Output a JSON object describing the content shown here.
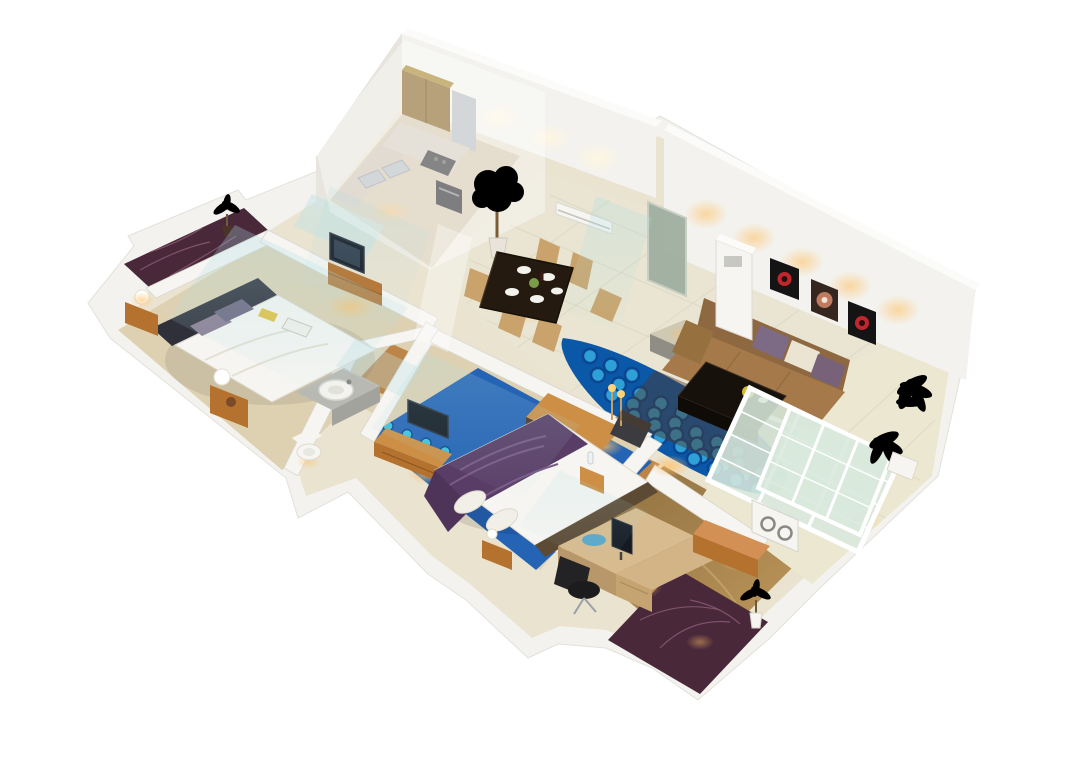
{
  "scene": {
    "type": "isometric-3d-apartment-floorplan-render",
    "background": "#ffffff",
    "rooms": [
      {
        "id": "master-bedroom",
        "furniture": [
          "double-bed",
          "headboard",
          "purple-pillows",
          "two-nightstands-with-lamps",
          "tv-dresser",
          "wall-tv"
        ]
      },
      {
        "id": "master-balcony",
        "furniture": [
          "dark-marble-floor",
          "potted-plant"
        ]
      },
      {
        "id": "bathroom",
        "furniture": [
          "round-basin-vanity",
          "toilet",
          "glass-partition"
        ]
      },
      {
        "id": "kitchen",
        "furniture": [
          "l-counter",
          "double-sink",
          "cooktop",
          "oven",
          "overhead-brown-cabinet",
          "fridge"
        ]
      },
      {
        "id": "dining-area",
        "furniture": [
          "dark-dining-table",
          "six-tan-chairs",
          "white-plates",
          "potted-tree"
        ]
      },
      {
        "id": "entry-hall",
        "furniture": [
          "recessed-entry-door",
          "console-sideboard",
          "floor-candles",
          "blue-river-floor-feature"
        ]
      },
      {
        "id": "living-room",
        "furniture": [
          "brown-sofa",
          "throw-cushions",
          "dark-coffee-table",
          "gray-ottoman",
          "tower-ac-unit",
          "wall-ac-unit",
          "three-wall-artworks",
          "french-glass-doors"
        ]
      },
      {
        "id": "second-bedroom",
        "furniture": [
          "double-bed",
          "purple-blanket",
          "blue-dotted-carpet",
          "tv-dresser",
          "nightstand"
        ]
      },
      {
        "id": "home-office",
        "furniture": [
          "l-shaped-desk",
          "monitor",
          "black-office-chair",
          "orange-cabinet",
          "glass-window-wall"
        ]
      },
      {
        "id": "right-balcony",
        "furniture": [
          "cream-tile-floor",
          "palm-plants",
          "white-planter",
          "outdoor-ac-unit"
        ]
      },
      {
        "id": "office-balcony",
        "furniture": [
          "dark-marble-floor",
          "potted-plant"
        ]
      }
    ]
  },
  "palette": {
    "wall": "#f3f2ee",
    "wallSide": "#e7e5de",
    "wallTop": "#fbfbf9",
    "underlay": "#e7dec8",
    "floorCream": "#e9e5d2",
    "tileLine": "#d5cfb6",
    "floorBeige": "#ded1b2",
    "floorKitchen": "#d5c9ae",
    "woodFloor": "#bd8448",
    "woodPlank": "#a06a34",
    "officeFloorA": "#8a6c3e",
    "officeFloorB": "#c39c5e",
    "balconyTile": "#ece7d0",
    "marble": "#49283a",
    "marbleVein": "#96647a",
    "river": "#0b57a8",
    "riverDot": "#2f9fd8",
    "riverRing": "#0a4790",
    "carpet": "#2563b4",
    "carpetDot": "#3ec2dc",
    "woodFurniture": "#b5722f",
    "woodFurnitureLight": "#cd8f45",
    "darkTable": "#241a10",
    "sofa": "#a5794a",
    "sofaBack": "#8d6840",
    "cushionPurple": "#7d6a84",
    "cushionCream": "#ece4d2",
    "blanketPurple": "#5a3d66",
    "chairTan": "#c9a36b",
    "white": "#f6f5f1",
    "gray": "#9a988f",
    "screenDark": "#141a22",
    "glass": "#d8e8dc",
    "glassPartition": "#bfe3e6",
    "beam": "#aadde4",
    "glowWarm": "#ffc168",
    "glowWhite": "#fff6e0",
    "artBlack": "#141414",
    "artRed": "#c0272d",
    "steel": "#b9bec2"
  },
  "decor": {
    "river_dots": {
      "r": 7,
      "step": {
        "dx": 21,
        "dy": 9.5
      },
      "rows": [
        {
          "x": 590,
          "y": 356,
          "n": 3
        },
        {
          "x": 598,
          "y": 375,
          "n": 5
        },
        {
          "x": 612,
          "y": 395,
          "n": 7
        },
        {
          "x": 634,
          "y": 416,
          "n": 9
        },
        {
          "x": 660,
          "y": 437,
          "n": 10
        },
        {
          "x": 694,
          "y": 459,
          "n": 9
        },
        {
          "x": 736,
          "y": 480,
          "n": 6
        },
        {
          "x": 786,
          "y": 497,
          "n": 3
        }
      ]
    },
    "carpet_dots": {
      "r": 5,
      "step": {
        "dx": 19,
        "dy": 8.5
      },
      "rows": [
        {
          "x": 388,
          "y": 426,
          "n": 4
        },
        {
          "x": 376,
          "y": 446,
          "n": 5
        },
        {
          "x": 372,
          "y": 468,
          "n": 5
        },
        {
          "x": 386,
          "y": 492,
          "n": 5
        },
        {
          "x": 412,
          "y": 516,
          "n": 5
        },
        {
          "x": 556,
          "y": 444,
          "n": 3
        },
        {
          "x": 574,
          "y": 466,
          "n": 4
        },
        {
          "x": 594,
          "y": 490,
          "n": 3
        },
        {
          "x": 548,
          "y": 514,
          "n": 4
        }
      ]
    }
  }
}
